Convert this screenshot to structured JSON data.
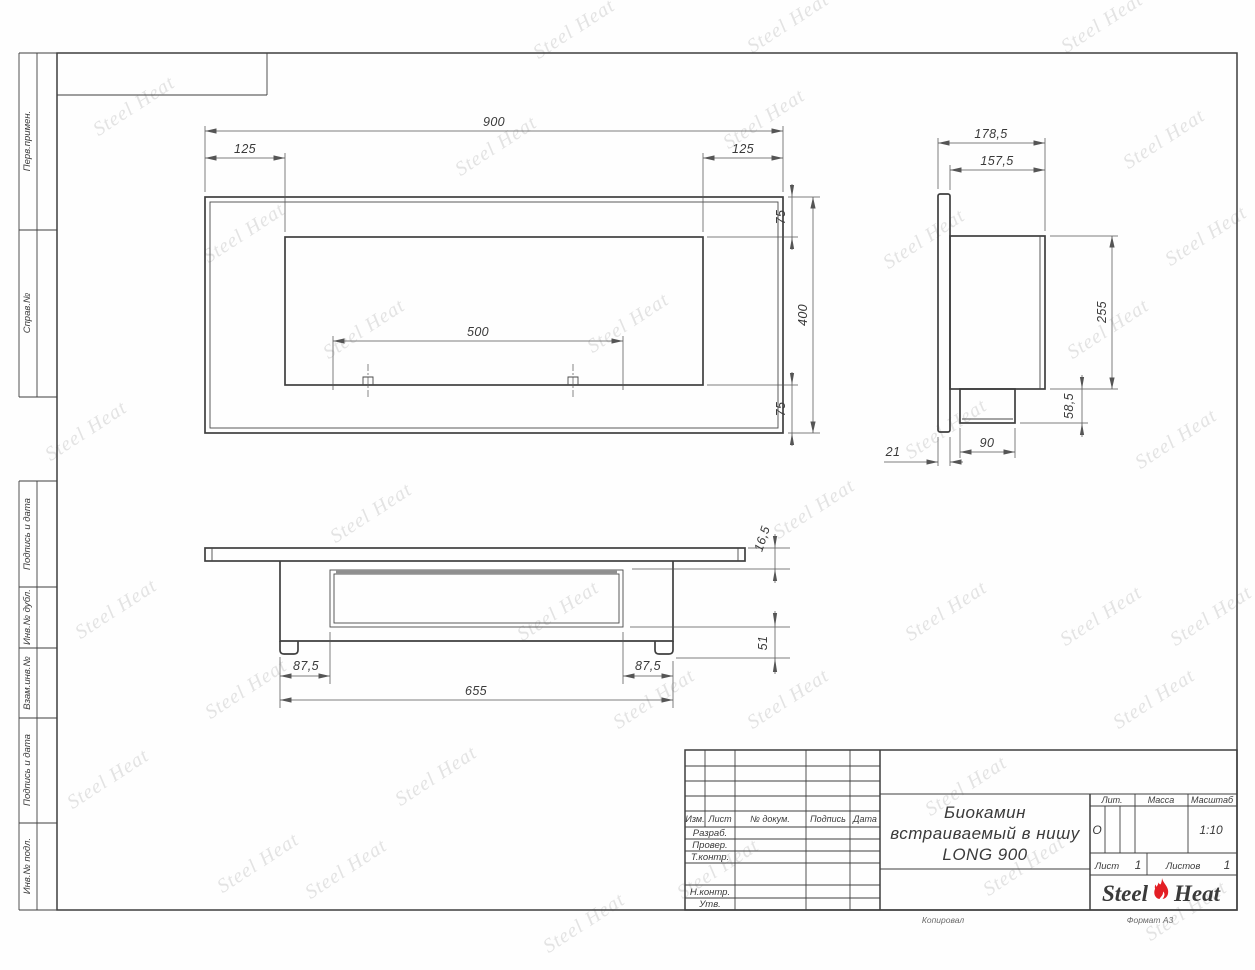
{
  "document": {
    "title_lines": [
      "Биокамин",
      "встраиваемый в нишу",
      "LONG 900"
    ],
    "liter_label": "Лит.",
    "liter_value": "О",
    "mass_label": "Масса",
    "scale_label": "Масштаб",
    "scale_value": "1:10",
    "sheet_label": "Лист",
    "sheet_value": "1",
    "sheets_label": "Листов",
    "sheets_value": "1",
    "footer_copy": "Копировал",
    "footer_format": "Формат А3"
  },
  "brand": {
    "word1": "Steel",
    "word2": "Heat",
    "flame_color": "#e31e24",
    "flame_icon": "flame-icon"
  },
  "watermark": {
    "text": "Steel Heat",
    "positions": [
      [
        88,
        95
      ],
      [
        40,
        420
      ],
      [
        70,
        598
      ],
      [
        62,
        768
      ],
      [
        198,
        222
      ],
      [
        200,
        678
      ],
      [
        212,
        852
      ],
      [
        318,
        318
      ],
      [
        325,
        502
      ],
      [
        390,
        765
      ],
      [
        300,
        858
      ],
      [
        528,
        18
      ],
      [
        512,
        600
      ],
      [
        538,
        912
      ],
      [
        582,
        312
      ],
      [
        608,
        688
      ],
      [
        450,
        135
      ],
      [
        718,
        108
      ],
      [
        742,
        12
      ],
      [
        742,
        688
      ],
      [
        768,
        498
      ],
      [
        878,
        228
      ],
      [
        900,
        418
      ],
      [
        920,
        775
      ],
      [
        1056,
        12
      ],
      [
        1062,
        318
      ],
      [
        1055,
        605
      ],
      [
        1118,
        128
      ],
      [
        1130,
        428
      ],
      [
        1160,
        225
      ],
      [
        1165,
        605
      ],
      [
        1108,
        688
      ],
      [
        1140,
        900
      ],
      [
        978,
        855
      ],
      [
        672,
        858
      ],
      [
        900,
        600
      ]
    ]
  },
  "title_block": {
    "header_cols": [
      "Изм.",
      "Лист",
      "№ докум.",
      "Подпись",
      "Дата"
    ],
    "rows": [
      "Разраб.",
      "Провер.",
      "Т.контр.",
      "Н.контр.",
      "Утв."
    ]
  },
  "sidebar": {
    "items": [
      "Перв.примен.",
      "Справ.№",
      "Подпись и дата",
      "Инв.№ дубл.",
      "Взам.инв.№",
      "Подпись и дата",
      "Инв.№ подл."
    ]
  },
  "dimensions": {
    "front": {
      "width": "900",
      "inset_left": "125",
      "inset_right": "125",
      "top": "75",
      "height": "400",
      "bottom": "75",
      "opening": "500"
    },
    "side": {
      "depth": "178,5",
      "body_depth": "157,5",
      "body_height": "255",
      "box_height": "58,5",
      "box_depth": "90",
      "flange": "21"
    },
    "top": {
      "plate": "16,5",
      "rear": "51",
      "margin_left": "87,5",
      "margin_right": "87,5",
      "body_width": "655"
    }
  }
}
